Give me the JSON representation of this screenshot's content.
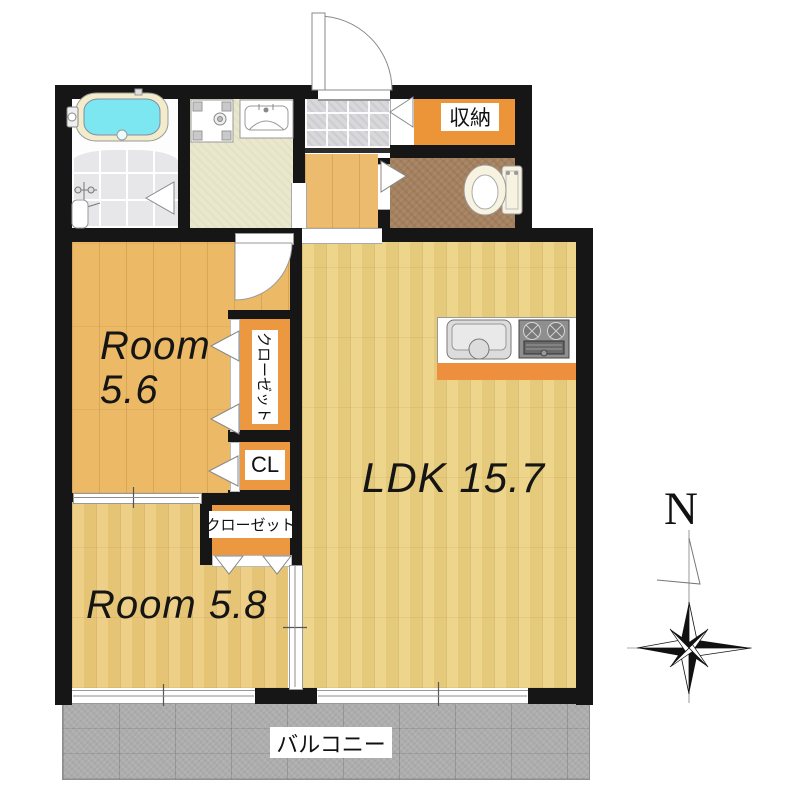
{
  "title": "apartment-floor-plan",
  "labels": {
    "room_5_6_line1": "Room",
    "room_5_6_line2": "5.6",
    "room_5_8": "Room 5.8",
    "ldk": "LDK 15.7",
    "storage": "収納",
    "closet_vertical": "クローゼット",
    "closet_small": "CL",
    "closet_horizontal": "クローゼット",
    "balcony": "バルコニー",
    "compass_north": "N"
  },
  "rooms": [
    {
      "label": "Room 5.6"
    },
    {
      "label": "Room 5.8"
    },
    {
      "label": "LDK 15.7"
    },
    {
      "label": "収納"
    },
    {
      "label": "クローゼット"
    },
    {
      "label": "CL"
    },
    {
      "label": "クローゼット"
    },
    {
      "label": "バルコニー"
    }
  ],
  "colors": {
    "wall": "#161616",
    "room_5_6_floor": "#ecba67",
    "room_5_8_floor": "#ecca79",
    "ldk_floor": "#ecd07f",
    "hallway_floor": "#ecbb6d",
    "closet_orange": "#ec9840",
    "storage_orange": "#ec9438",
    "kitchen_counter_orange": "#ed8f3c",
    "toilet_floor_brown": "#a5815f",
    "washroom_floor": "#eae8cc",
    "bathroom_tile": "#e7e6e9",
    "genkan_tile": "#d8d8dc",
    "balcony_gray": "#adadad",
    "bathtub_water": "#7ce7f0",
    "fixture_cream": "#f2ecca"
  }
}
